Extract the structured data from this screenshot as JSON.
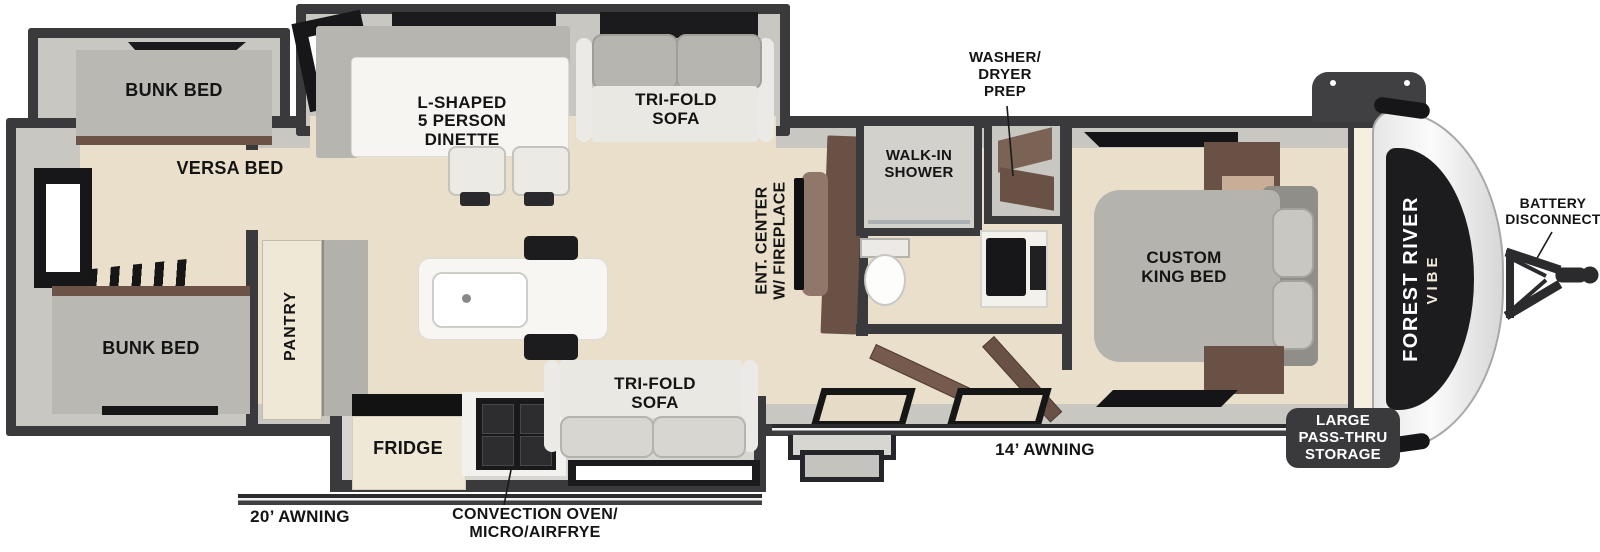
{
  "page": {
    "title": "Forest River Vibe travel trailer floor plan",
    "background": "#ffffff"
  },
  "colors": {
    "wall": "#3a3a3c",
    "interior_wall": "#c9c7c2",
    "floor": "#eadfca",
    "walkway": "#d8d6d1",
    "wood": "#6a5146",
    "wood_light": "#91776a",
    "cream_cabinet": "#efe8d6",
    "mattress_gray": "#b5b3ae",
    "sofa_white": "#eae8e3",
    "marble": "#f7f5f1",
    "appliance_black": "#19191b",
    "badge_dark": "#3a3a3d",
    "cap_panel_black": "#1c1c1f"
  },
  "labels": {
    "bunk_bed_top": "BUNK BED",
    "versa_bed": "VERSA BED",
    "bunk_bed_bottom": "BUNK BED",
    "pantry": "PANTRY",
    "dinette": "L-SHAPED\n5 PERSON\nDINETTE",
    "tri_fold_sofa_top": "TRI-FOLD\nSOFA",
    "tri_fold_sofa_bottom": "TRI-FOLD\nSOFA",
    "fridge": "FRIDGE",
    "convection": "CONVECTION OVEN/\nMICRO/AIRFRYE",
    "awning_rear": "20’ AWNING",
    "awning_main": "14’ AWNING",
    "ent_center": "ENT. CENTER\nW/ FIREPLACE",
    "walk_in_shower": "WALK-IN\nSHOWER",
    "washer_dryer_prep": "WASHER/\nDRYER\nPREP",
    "custom_king_bed": "CUSTOM\nKING BED",
    "pass_thru_storage": "LARGE\nPASS-THRU\nSTORAGE",
    "battery_disconnect": "BATTERY\nDISCONNECT",
    "brand_line1": "FOREST RIVER",
    "brand_line2": "VIBE"
  }
}
